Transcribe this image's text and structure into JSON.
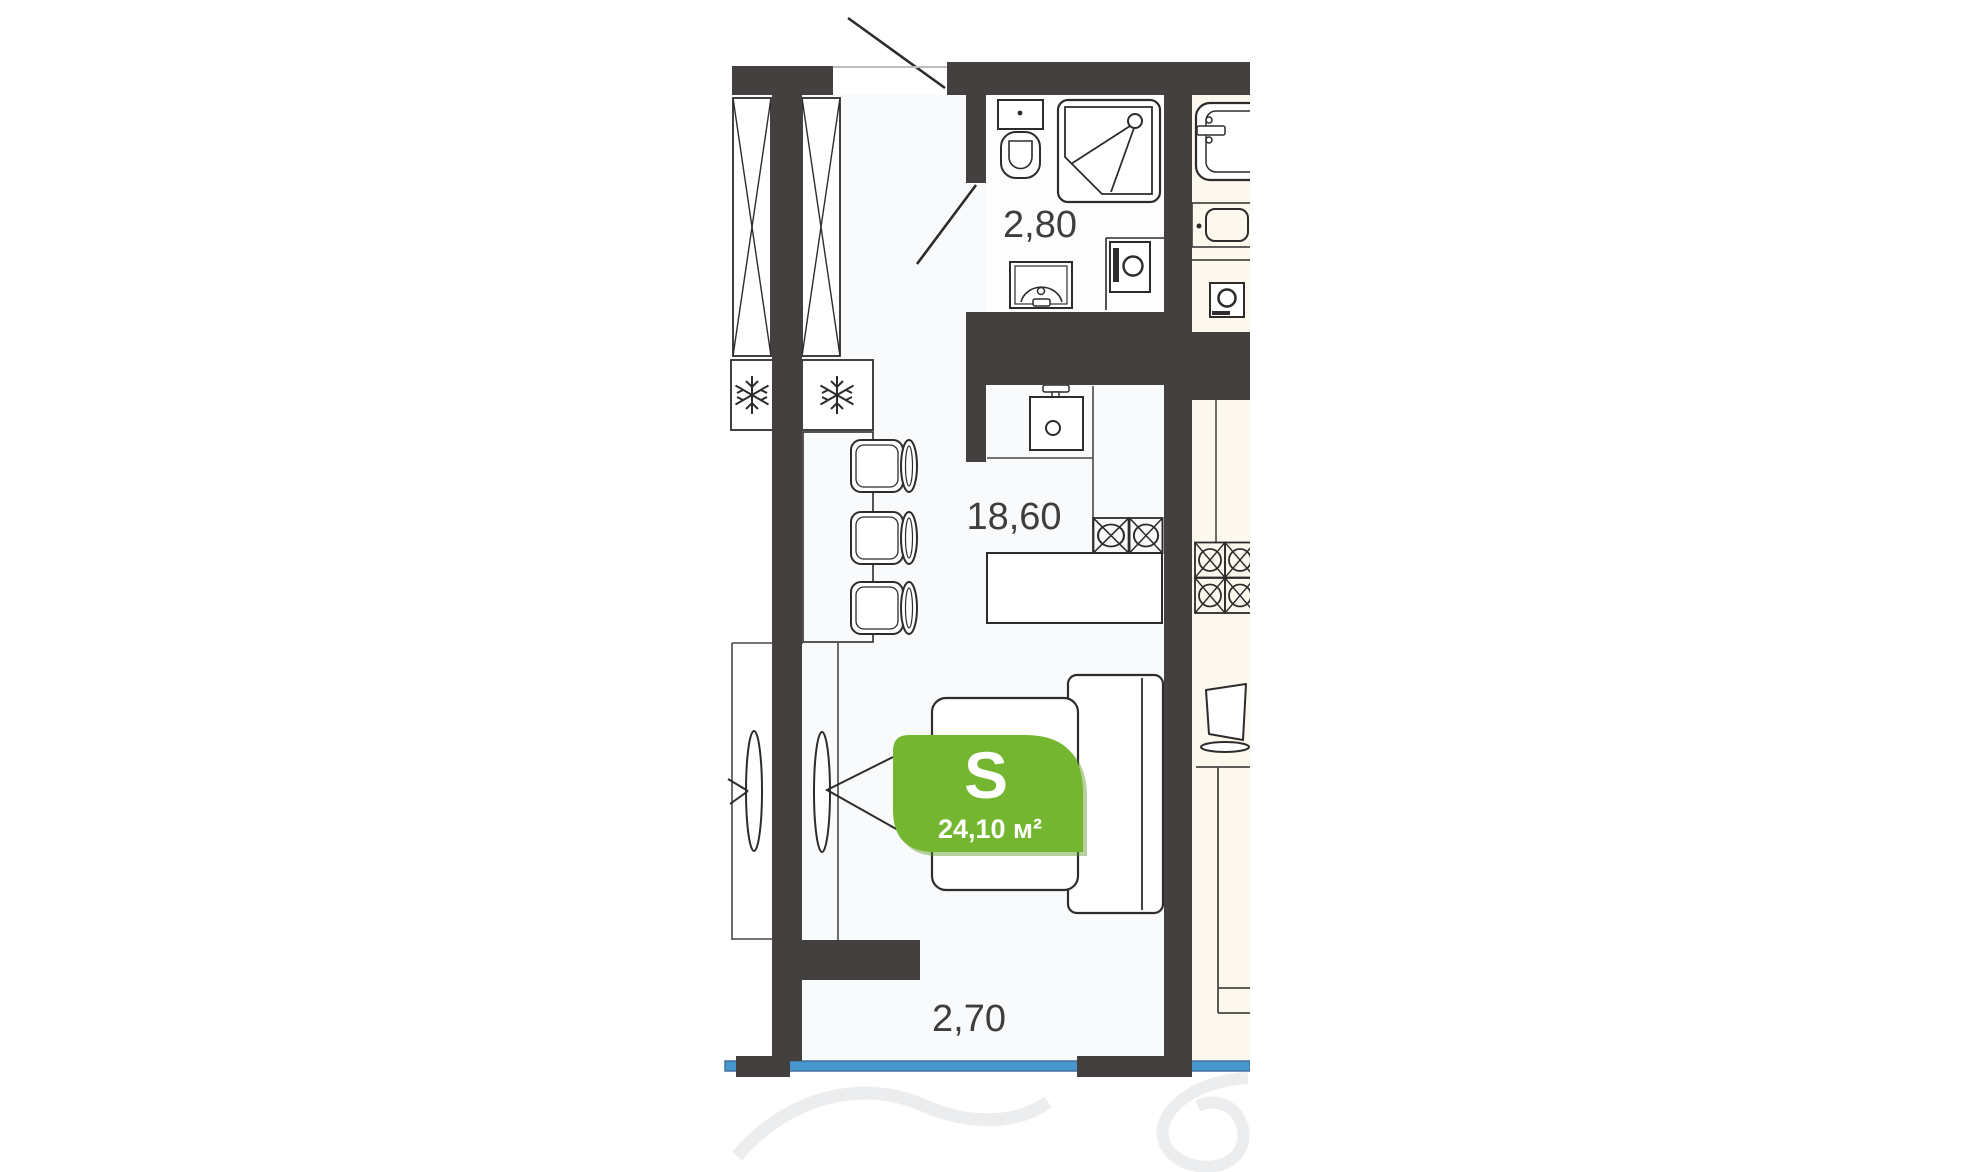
{
  "title": "studio-apartment-floor-plan",
  "badge": {
    "letter": "S",
    "area_value": "24,10 м²",
    "color_green": "#74b62f",
    "shadow_green": "#5e9a28"
  },
  "dimensions": {
    "bathroom": "2,80",
    "living": "18,60",
    "width_bottom": "2,70"
  },
  "colors": {
    "wall": "#444040",
    "fixture_line": "#2e2c2b",
    "neighbor_floor": "#fcf8ee",
    "main_floor_tint": "#f7f9fb",
    "window_blue": "#4697cd",
    "window_blue_edge": "#44719f",
    "dimension_text": "#3e3e3e",
    "watermark": "#e9eaec"
  },
  "legend_fixtures": [
    "wardrobe-x-box",
    "fridge-snowflake",
    "bar-counter",
    "chair",
    "toilet",
    "shower-cabin",
    "washbasin",
    "washing-machine",
    "kitchen-sink",
    "stove-burner",
    "dining-table",
    "sofa",
    "bed",
    "bathtub",
    "tv",
    "door-swing",
    "sliding-door-leaf",
    "window-line"
  ]
}
